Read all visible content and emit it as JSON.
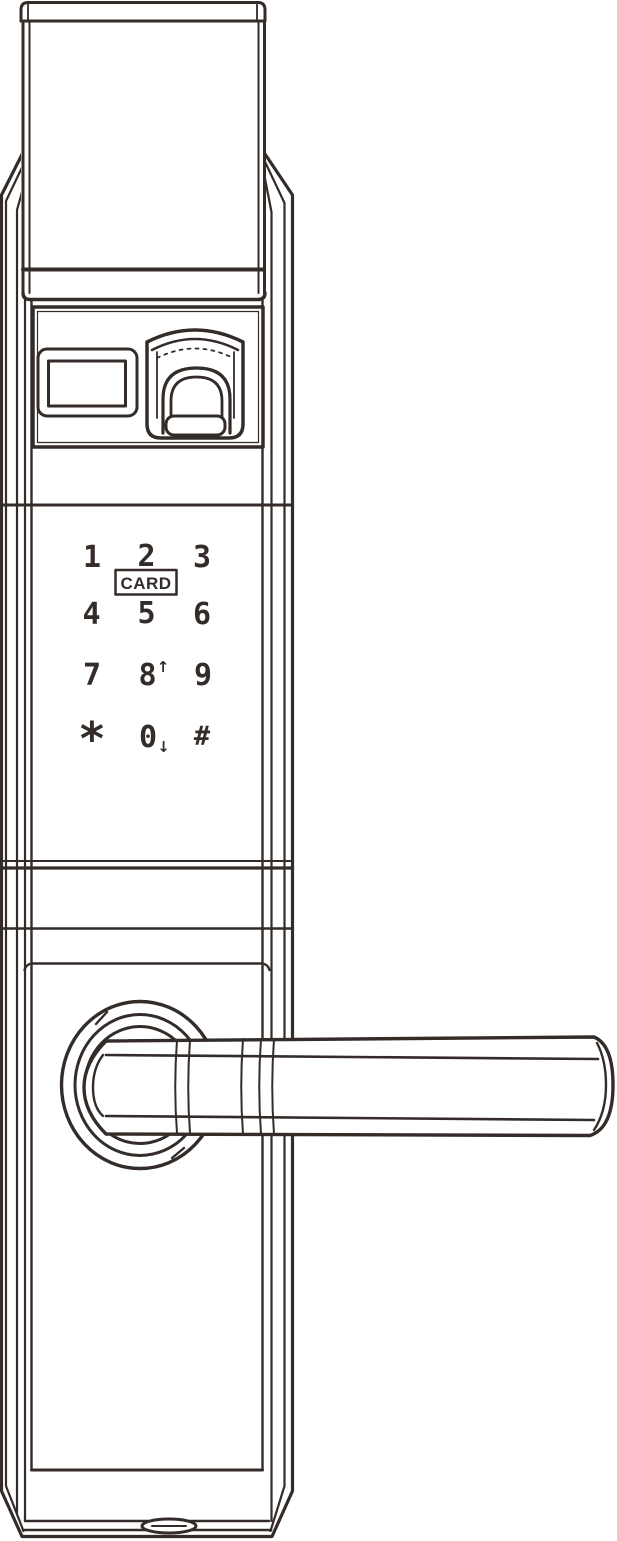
{
  "colors": {
    "line": "#332c29",
    "background": "#ffffff"
  },
  "keypad": {
    "keys": [
      {
        "label": "1"
      },
      {
        "label": "2"
      },
      {
        "label": "3"
      },
      {
        "label": "4"
      },
      {
        "label": "5"
      },
      {
        "label": "6"
      },
      {
        "label": "7"
      },
      {
        "label": "8",
        "suffix": "↑"
      },
      {
        "label": "9"
      },
      {
        "label": "*"
      },
      {
        "label": "0",
        "suffix": "↓"
      },
      {
        "label": "#"
      }
    ],
    "card_label": "CARD"
  }
}
